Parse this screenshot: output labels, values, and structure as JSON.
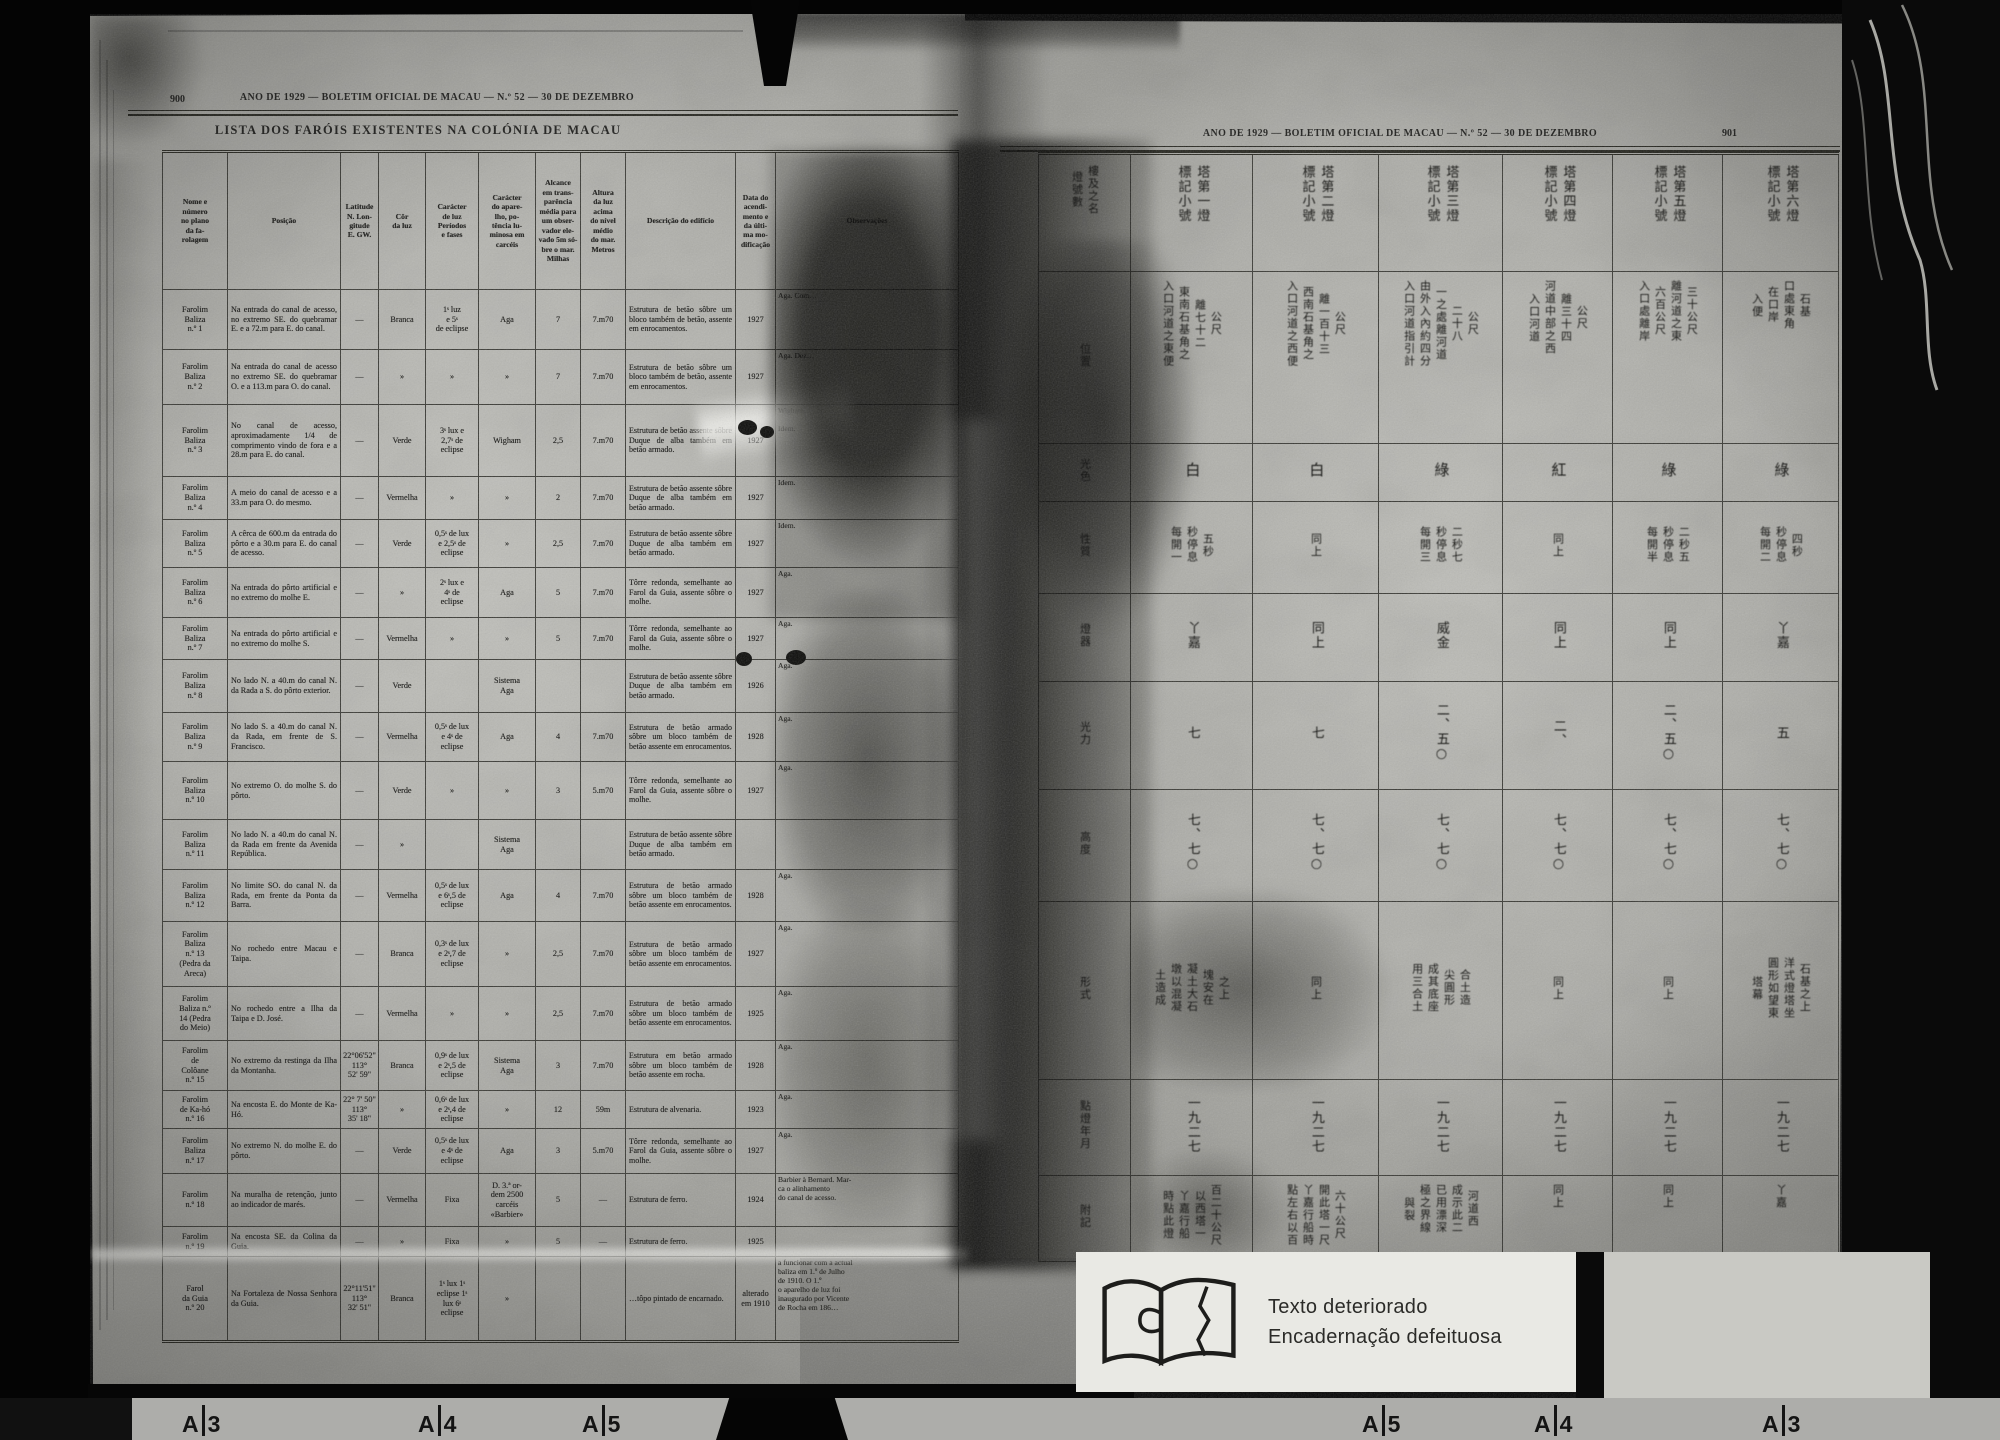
{
  "left_page": {
    "page_number": "900",
    "running_header": "ANO DE 1929 — BOLETIM OFICIAL DE MACAU — N.º 52 — 30 DE DEZEMBRO",
    "title": "LISTA DOS FARÓIS EXISTENTES NA COLÓNIA DE MACAU",
    "columns": [
      "Nome e\nnúmero\nno plano\nda fa-\nrolagem",
      "Posição",
      "Latitude\nN. Lon-\ngitude\nE. GW.",
      "Côr\nda luz",
      "Carácter\nde luz\nPeríodos\ne fases",
      "Carácter\ndo apare-\nlho, po-\ntência lu-\nminosa em\ncarcéis",
      "Alcance\nem trans-\nparência\nmédia para\num obser-\nvador ele-\nvado 5m só-\nbre o mar.\nMilhas",
      "Altura\nda luz\nacima\ndo nível\nmédio\ndo mar.\nMetros",
      "Descrição do edifício",
      "Data do\nacendi-\nmento e\nda últi-\nma mo-\ndificação",
      "Observações"
    ],
    "rows": [
      {
        "name": "Farolim\nBaliza\nn.º 1",
        "position": "Na entrada do canal de acesso, no extremo SE. do quebramar E. e a 72.m para E. do canal.",
        "latitude": "—",
        "color": "Branca",
        "light_character": "1ˢ luz\ne 5ˢ\nde eclipse",
        "apparatus": "Aga",
        "range_miles": "7",
        "height_m": "7.m70",
        "description": "Estrutura de betão sôbre um bloco também de betão, assente em enrocamentos.",
        "date": "1927",
        "notes": "Aga. Com…"
      },
      {
        "name": "Farolim\nBaliza\nn.º 2",
        "position": "Na entrada do canal de acesso no extremo SE. do quebramar O. e a 113.m para O. do canal.",
        "latitude": "—",
        "color": "»",
        "light_character": "»",
        "apparatus": "»",
        "range_miles": "7",
        "height_m": "7.m70",
        "description": "Estrutura de betão sôbre um bloco também de betão, assente em enrocamentos.",
        "date": "1927",
        "notes": "Aga. Dez…"
      },
      {
        "name": "Farolim\nBaliza\nn.º 3",
        "position": "No canal de acesso, aproximadamente 1/4 de comprimento vindo de fora e a 28.m para E. do canal.",
        "latitude": "—",
        "color": "Verde",
        "light_character": "3ˢ lux e\n2,7ˢ de\neclipse",
        "apparatus": "Wigham",
        "range_miles": "2,5",
        "height_m": "7.m70",
        "description": "Estrutura de betão assente sôbre Duque de alba também em betão armado.",
        "date": "1927",
        "notes": "Wigham…\n\nIdem."
      },
      {
        "name": "Farolim\nBaliza\nn.º 4",
        "position": "A meio do canal de acesso e a 33.m para O. do mesmo.",
        "latitude": "—",
        "color": "Vermelha",
        "light_character": "»",
        "apparatus": "»",
        "range_miles": "2",
        "height_m": "7.m70",
        "description": "Estrutura de betão assente sôbre Duque de alba também em betão armado.",
        "date": "1927",
        "notes": "Idem."
      },
      {
        "name": "Farolim\nBaliza\nn.º 5",
        "position": "A cêrca de 600.m da entrada do pôrto e a 30.m para E. do canal de acesso.",
        "latitude": "—",
        "color": "Verde",
        "light_character": "0,5ˢ de lux\ne 2,5ˢ de\neclipse",
        "apparatus": "»",
        "range_miles": "2,5",
        "height_m": "7.m70",
        "description": "Estrutura de betão assente sôbre Duque de alba também em betão armado.",
        "date": "1927",
        "notes": "Idem."
      },
      {
        "name": "Farolim\nBaliza\nn.º 6",
        "position": "Na entrada do pôrto artificial e no extremo do molhe E.",
        "latitude": "—",
        "color": "»",
        "light_character": "2ˢ lux e\n4ˢ de\neclipse",
        "apparatus": "Aga",
        "range_miles": "5",
        "height_m": "7.m70",
        "description": "Tôrre redonda, semelhante ao Farol da Guia, assente sôbre o molhe.",
        "date": "1927",
        "notes": "Aga."
      },
      {
        "name": "Farolim\nBaliza\nn.º 7",
        "position": "Na entrada do pôrto artificial e no extremo do molhe S.",
        "latitude": "—",
        "color": "Vermelha",
        "light_character": "»",
        "apparatus": "»",
        "range_miles": "5",
        "height_m": "7.m70",
        "description": "Tôrre redonda, semelhante ao Farol da Guia, assente sôbre o molhe.",
        "date": "1927",
        "notes": "Aga."
      },
      {
        "name": "Farolim\nBaliza\nn.º 8",
        "position": "No lado N. a 40.m do canal N. da Rada a S. do pôrto exterior.",
        "latitude": "—",
        "color": "Verde",
        "light_character": "",
        "apparatus": "Sistema\nAga",
        "range_miles": "",
        "height_m": "",
        "description": "Estrutura de betão assente sôbre Duque de alba também em betão armado.",
        "date": "1926",
        "notes": "Aga."
      },
      {
        "name": "Farolim\nBaliza\nn.º 9",
        "position": "No lado S. a 40.m do canal N. da Rada, em frente de S. Francisco.",
        "latitude": "—",
        "color": "Vermelha",
        "light_character": "0,5ˢ de lux\ne 4ˢ de\neclipse",
        "apparatus": "Aga",
        "range_miles": "4",
        "height_m": "7.m70",
        "description": "Estrutura de betão armado sôbre um bloco também de betão assente em enrocamentos.",
        "date": "1928",
        "notes": "Aga."
      },
      {
        "name": "Farolim\nBaliza\nn.º 10",
        "position": "No extremo O. do molhe S. do pôrto.",
        "latitude": "—",
        "color": "Verde",
        "light_character": "»",
        "apparatus": "»",
        "range_miles": "3",
        "height_m": "5.m70",
        "description": "Tôrre redonda, semelhante ao Farol da Guia, assente sôbre o molhe.",
        "date": "1927",
        "notes": "Aga."
      },
      {
        "name": "Farolim\nBaliza\nn.º 11",
        "position": "No lado N. a 40.m do canal N. da Rada em frente da Avenida República.",
        "latitude": "—",
        "color": "»",
        "light_character": "",
        "apparatus": "Sistema\nAga",
        "range_miles": "",
        "height_m": "",
        "description": "Estrutura de betão assente sôbre Duque de alba também em betão armado.",
        "date": "",
        "notes": ""
      },
      {
        "name": "Farolim\nBaliza\nn.º 12",
        "position": "No limite SO. do canal N. da Rada, em frente da Ponta da Barra.",
        "latitude": "—",
        "color": "Vermelha",
        "light_character": "0,5ˢ de lux\ne 6ˢ,5 de\neclipse",
        "apparatus": "Aga",
        "range_miles": "4",
        "height_m": "7.m70",
        "description": "Estrutura de betão armado sôbre um bloco também de betão assente em enrocamentos.",
        "date": "1928",
        "notes": "Aga."
      },
      {
        "name": "Farolim\nBaliza\nn.º 13\n(Pedra da\nAreca)",
        "position": "No rochedo entre Macau e Taipa.",
        "latitude": "—",
        "color": "Branca",
        "light_character": "0,3ˢ de lux\ne 2ˢ,7 de\neclipse",
        "apparatus": "»",
        "range_miles": "2,5",
        "height_m": "7.m70",
        "description": "Estrutura de betão armado sôbre um bloco também de betão assente em enrocamentos.",
        "date": "1927",
        "notes": "Aga."
      },
      {
        "name": "Farolim\nBaliza n.º\n14 (Pedra\ndo Meio)",
        "position": "No rochedo entre a Ilha da Taipa e D. José.",
        "latitude": "—",
        "color": "Vermelha",
        "light_character": "»",
        "apparatus": "»",
        "range_miles": "2,5",
        "height_m": "7.m70",
        "description": "Estrutura de betão armado sôbre um bloco também de betão assente em enrocamentos.",
        "date": "1925",
        "notes": "Aga."
      },
      {
        "name": "Farolim\nde\nColôane\nn.º 15",
        "position": "No extremo da restinga da Ilha da Montanha.",
        "latitude": "22°06'52\"\n113°\n52' 59\"",
        "color": "Branca",
        "light_character": "0,9ˢ de lux\ne 2ˢ,5 de\neclipse",
        "apparatus": "Sistema\nAga",
        "range_miles": "3",
        "height_m": "7.m70",
        "description": "Estrutura em betão armado sôbre um bloco também de betão assente em rocha.",
        "date": "1928",
        "notes": "Aga."
      },
      {
        "name": "Farolim\nde Ka-hó\nn.º 16",
        "position": "Na encosta E. do Monte de Ka-Hó.",
        "latitude": "22° 7' 50\"\n113°\n35' 18\"",
        "color": "»",
        "light_character": "0,6ˢ de lux\ne 2ˢ,4 de\neclipse",
        "apparatus": "»",
        "range_miles": "12",
        "height_m": "59m",
        "description": "Estrutura de alvenaria.",
        "date": "1923",
        "notes": "Aga."
      },
      {
        "name": "Farolim\nBaliza\nn.º 17",
        "position": "No extremo N. do molhe E. do pôrto.",
        "latitude": "—",
        "color": "Verde",
        "light_character": "0,5ˢ de lux\ne 4ˢ de\neclipse",
        "apparatus": "Aga",
        "range_miles": "3",
        "height_m": "5.m70",
        "description": "Tôrre redonda, semelhante ao Farol da Guia, assente sôbre o molhe.",
        "date": "1927",
        "notes": "Aga."
      },
      {
        "name": "Farolim\nn.º 18",
        "position": "Na muralha de retenção, junto ao indicador de marés.",
        "latitude": "—",
        "color": "Vermelha",
        "light_character": "Fixa",
        "apparatus": "D. 3.ª or-\ndem 2500\ncarcéis\n«Barbier»",
        "range_miles": "5",
        "height_m": "—",
        "description": "Estrutura de ferro.",
        "date": "1924",
        "notes": "Barbier à Bernard. Mar-\nca o alinhamento\ndo canal de acesso."
      },
      {
        "name": "Farolim\nn.º 19",
        "position": "Na encosta SE. da Colina da Guia.",
        "latitude": "—",
        "color": "»",
        "light_character": "Fixa",
        "apparatus": "»",
        "range_miles": "5",
        "height_m": "—",
        "description": "Estrutura de ferro.",
        "date": "1925",
        "notes": ""
      },
      {
        "name": "Farol\nda Guia\nn.º 20",
        "position": "Na Fortaleza de Nossa Senhora da Guia.",
        "latitude": "22°11'51\"\n113°\n32' 51\"",
        "color": "Branca",
        "light_character": "1ˢ lux 1ˢ\neclipse 1ˢ\nlux 6ˢ\neclipse",
        "apparatus": "»",
        "range_miles": "",
        "height_m": "",
        "description": "…tôpo pintado de encarnado.",
        "date": "alterado\nem 1910",
        "notes": "a funcionar com a actual\nbaliza em 1.º de Julho\nde 1910. O 1.º\no aparelho de luz foi\ninaugurado por Vicente\nde Rocha em 186…"
      }
    ]
  },
  "right_page": {
    "page_number": "901",
    "running_header": "ANO DE 1929 — BOLETIM OFICIAL DE MACAU — N.º 52 — 30 DE DEZEMBRO",
    "corner_header_lines": [
      "樓及之名",
      "燈號數"
    ],
    "column_headers": [
      [
        "塔第一燈",
        "標記小號"
      ],
      [
        "塔第二燈",
        "標記小號"
      ],
      [
        "塔第三燈",
        "標記小號"
      ],
      [
        "塔第四燈",
        "標記小號"
      ],
      [
        "塔第五燈",
        "標記小號"
      ],
      [
        "塔第六燈",
        "標記小號"
      ]
    ],
    "row_labels": [
      "位置",
      "光色",
      "性質",
      "燈器",
      "光力",
      "高度",
      "形式",
      "點燈年月",
      "附記"
    ],
    "rows": {
      "position": [
        [
          "公尺",
          "離七十二",
          "東南石基角之",
          "入口河道之東便"
        ],
        [
          "公尺",
          "離一百十三",
          "西南石基角之",
          "入口河道之西便"
        ],
        [
          "公尺",
          "二十八",
          "一之處離河道",
          "由外入內約四分",
          "入口河道指引計"
        ],
        [
          "公尺",
          "離三十四",
          "河道中部之西",
          "入口河道"
        ],
        [
          "三十公尺",
          "離河道之東",
          "六百公尺",
          "入口處離岸"
        ],
        [
          "石基",
          "口處東角",
          "在口岸",
          "入便"
        ]
      ],
      "color": [
        "白",
        "白",
        "綠",
        "紅",
        "綠",
        "綠"
      ],
      "character": [
        [
          "五秒",
          "秒停息",
          "每開一"
        ],
        [
          "同上"
        ],
        [
          "二秒七",
          "秒停息",
          "每開三"
        ],
        [
          "同上"
        ],
        [
          "二秒五",
          "秒停息",
          "每開半"
        ],
        [
          "四秒",
          "秒停息",
          "每開二"
        ]
      ],
      "apparatus": [
        [
          "丫嘉"
        ],
        [
          "同上"
        ],
        [
          "威金"
        ],
        [
          "同上"
        ],
        [
          "同上"
        ],
        [
          "丫嘉"
        ]
      ],
      "power": [
        "七",
        "七",
        "二、五○",
        "二、",
        "二、五○",
        "五"
      ],
      "height": [
        "七、七○",
        "七、七○",
        "七、七○",
        "七、七○",
        "七、七○",
        "七、七○"
      ],
      "structure": [
        [
          "之上",
          "塊安在",
          "凝土大石",
          "墩以混凝",
          "土造成"
        ],
        [
          "同上"
        ],
        [
          "合土造",
          "尖圓形",
          "成其底座",
          "用三合土"
        ],
        [
          "同上"
        ],
        [
          "同上"
        ],
        [
          "石基之上",
          "洋式燈塔坐",
          "圓形如望東",
          "塔幕"
        ]
      ],
      "year": [
        "一九二七",
        "一九二七",
        "一九二七",
        "一九二七",
        "一九二七",
        "一九二七"
      ],
      "notes": [
        [
          "百二十公尺",
          "以西塔一",
          "丫嘉行船",
          "時點此燈"
        ],
        [
          "六十公尺",
          "開此塔一尺",
          "丫嘉行船時",
          "點左右以百"
        ],
        [
          "河道西",
          "成示此二",
          "已用漂深",
          "極之界線",
          "與裂"
        ],
        [
          "同上"
        ],
        [
          "同上"
        ],
        [
          "丫嘉"
        ]
      ]
    }
  },
  "annotation": {
    "note_line1": "Texto deteriorado",
    "note_line2": "Encadernação defeituosa",
    "film_letter": "A",
    "film_markers": [
      "3",
      "4",
      "5",
      "5",
      "4",
      "3"
    ]
  }
}
